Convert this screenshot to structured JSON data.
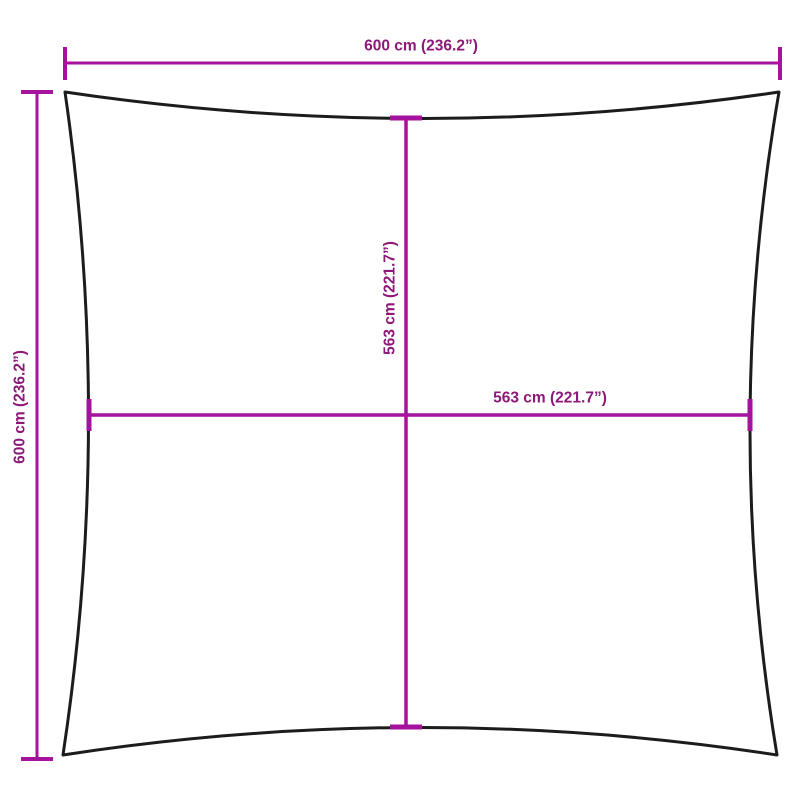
{
  "diagram": {
    "type": "product-dimension-diagram",
    "shape": "square-shade-sail",
    "colors": {
      "dimension_line": "#A5129E",
      "dimension_text": "#8D1878",
      "outline": "#1c1c1c",
      "background": "#ffffff"
    },
    "dimensions": {
      "outer_width": {
        "label": "600 cm (236.2”)",
        "cm": 600,
        "inches": 236.2,
        "orientation": "horizontal",
        "position": "top"
      },
      "outer_height": {
        "label": "600 cm (236.2”)",
        "cm": 600,
        "inches": 236.2,
        "orientation": "vertical",
        "position": "left"
      },
      "inner_height": {
        "label": "563 cm (221.7”)",
        "cm": 563,
        "inches": 221.7,
        "orientation": "vertical",
        "position": "center"
      },
      "inner_width": {
        "label": "563 cm (221.7”)",
        "cm": 563,
        "inches": 221.7,
        "orientation": "horizontal",
        "position": "center"
      }
    }
  }
}
